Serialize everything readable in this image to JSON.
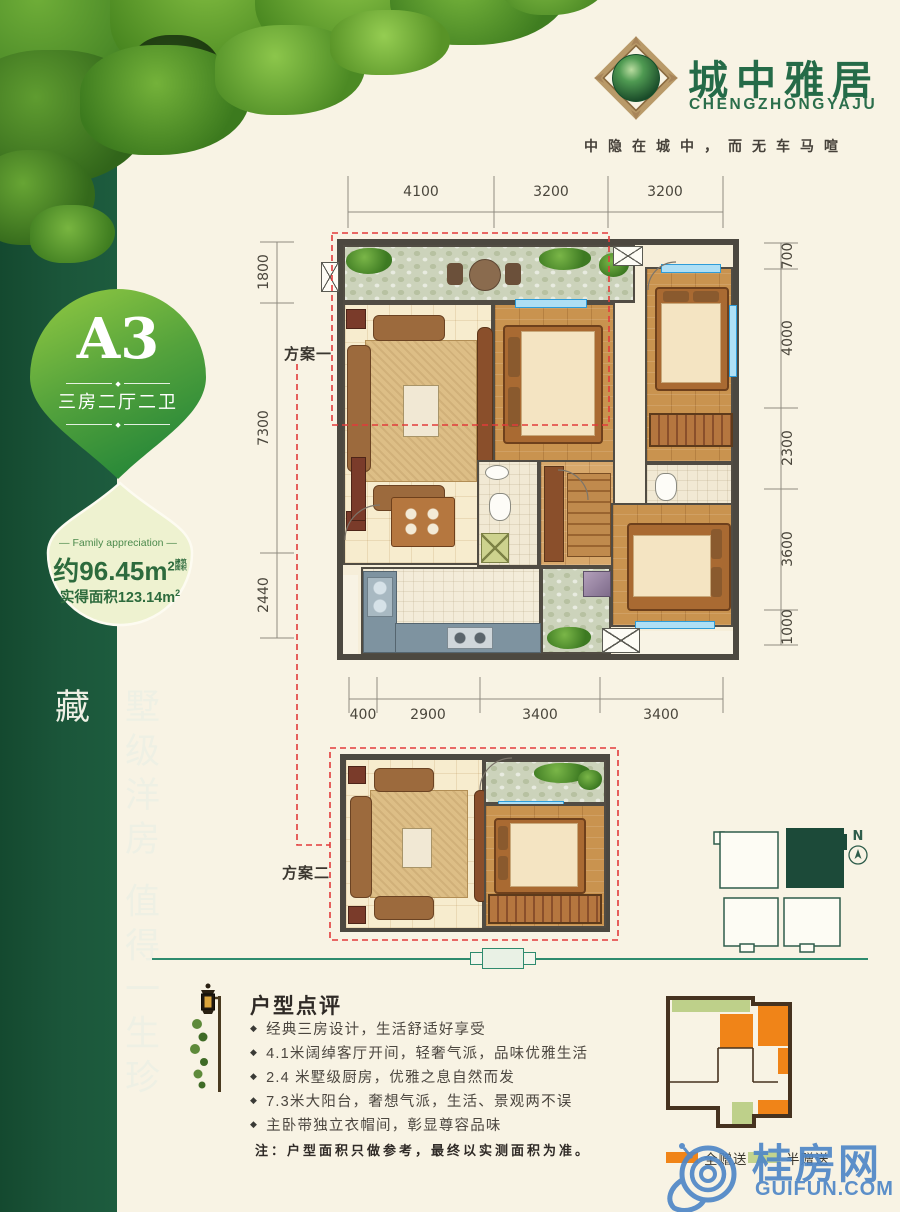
{
  "brand": {
    "name": "城中雅居",
    "latin": "CHENGZHONGYAJU",
    "tagline": "中隐在城中，而无车马喧"
  },
  "badge": {
    "unit": "A3",
    "layout": "三房二厅二卫",
    "sep_icon": "◆"
  },
  "area": {
    "tag_en": "Family appreciation",
    "build_value": "约96.45m",
    "build_sup": "2",
    "build_note": "建筑面积",
    "actual_value": "实得面积123.14m",
    "actual_sup": "2"
  },
  "slogan": "墅级洋房 值得一生珍藏",
  "plans": {
    "plan1_label": "方案一",
    "plan2_label": "方案二"
  },
  "dimensions": {
    "top": [
      "4100",
      "3200",
      "3200"
    ],
    "bottom": [
      "400",
      "2900",
      "3400",
      "3400"
    ],
    "left": [
      "1800",
      "7300",
      "2440"
    ],
    "right": [
      "700",
      "4000",
      "2300",
      "3600",
      "1000"
    ]
  },
  "review": {
    "title": "户型点评",
    "bullet_icon": "◆",
    "bullets": [
      "经典三房设计，生活舒适好享受",
      "4.1米阔绰客厅开间，轻奢气派，品味优雅生活",
      "2.4 米墅级厨房，优雅之息自然而发",
      "7.3米大阳台，奢想气派，生活、景观两不误",
      "主卧带独立衣帽间，彰显尊容品味"
    ],
    "note": "注：户型面积只做参考，最终以实测面积为准。"
  },
  "legend": {
    "full_label": "全赠送",
    "full_color": "#f08418",
    "half_label": "半赠送",
    "half_color": "#c3d48e"
  },
  "keyplan": {
    "north": "N"
  },
  "watermark": {
    "cn": "桂房网",
    "en": "GUIFUN.COM"
  },
  "colors": {
    "sidebar_green": "#1b563a",
    "brand_green": "#256b48",
    "drop_light": "#eef2d0",
    "red_dash": "#e23b3b",
    "divider_teal": "#2e8b6e",
    "watermark_blue": "#4f87c7"
  }
}
